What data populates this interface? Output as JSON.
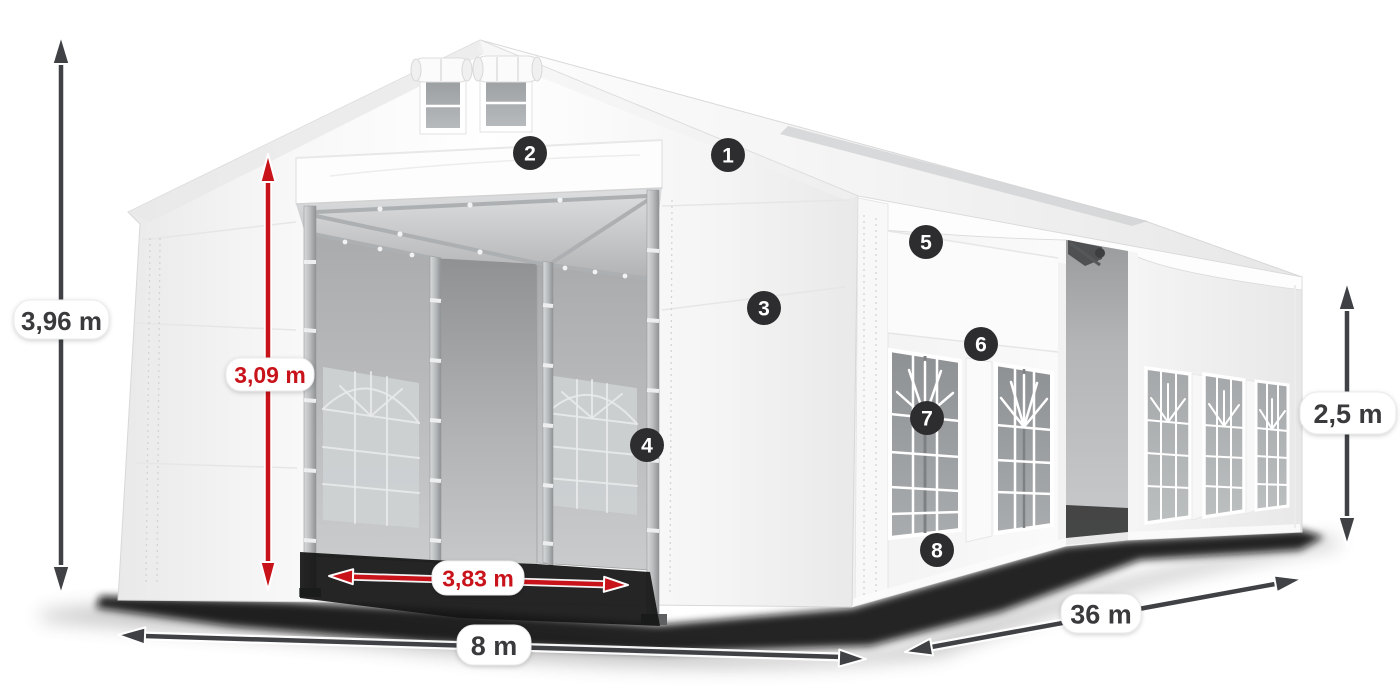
{
  "diagram": {
    "title": "storage-tent-dimension-diagram",
    "dimension_labels": {
      "total_height": "3,96 m",
      "entrance_height": "3,09 m",
      "entrance_width": "3,83 m",
      "tent_width": "8 m",
      "tent_length": "36 m",
      "side_height": "2,5 m"
    },
    "feature_badges": [
      {
        "number": "1"
      },
      {
        "number": "2"
      },
      {
        "number": "3"
      },
      {
        "number": "4"
      },
      {
        "number": "5"
      },
      {
        "number": "6"
      },
      {
        "number": "7"
      },
      {
        "number": "8"
      }
    ],
    "colors": {
      "dimension_red": "#c8131a",
      "dimension_dark": "#3f4145",
      "badge_background": "#2d2d2f",
      "badge_text": "#ffffff",
      "label_background": "#ffffff",
      "label_text": "#3a3a3c"
    }
  }
}
